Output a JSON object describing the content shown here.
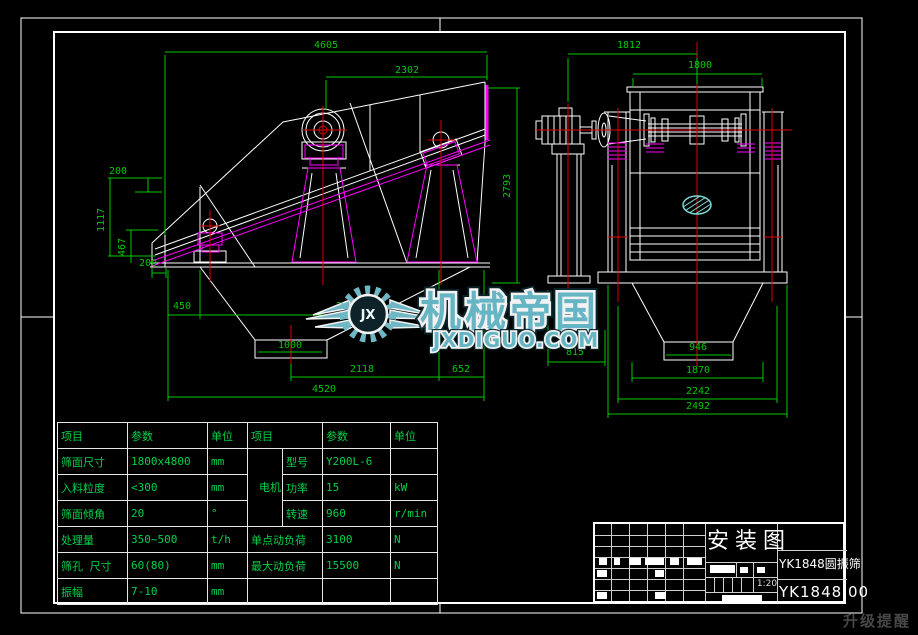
{
  "sheet": {
    "title": "安装图",
    "product": "YK1848圆振筛",
    "drawing_no": "YK1848.00",
    "scale": "1:20"
  },
  "watermark": {
    "monogram": "JX",
    "brand": "机械帝国",
    "domain": "JXDIGUO.COM"
  },
  "corner_note": "升级提醒",
  "param_table_left": {
    "headers": [
      "项目",
      "参数",
      "单位"
    ],
    "rows": [
      [
        "筛面尺寸",
        "1800x4800",
        "mm"
      ],
      [
        "入料粒度",
        "<300",
        "mm"
      ],
      [
        "筛面倾角",
        "20",
        "°"
      ],
      [
        "处理量",
        "350~500",
        "t/h"
      ],
      [
        "筛孔 尺寸",
        "60(80)",
        "mm"
      ],
      [
        "振幅",
        "7-10",
        "mm"
      ]
    ]
  },
  "param_table_right": {
    "headers": [
      "项目",
      "参数",
      "单位"
    ],
    "motor_label": "电机",
    "motor_rows": [
      [
        "型号",
        "Y200L-6",
        ""
      ],
      [
        "功率",
        "15",
        "kW"
      ],
      [
        "转速",
        "960",
        "r/min"
      ]
    ],
    "rows": [
      [
        "单点动负荷",
        "3100",
        "N"
      ],
      [
        "最大动负荷",
        "15500",
        "N"
      ],
      [
        "",
        "",
        ""
      ]
    ]
  },
  "dims": {
    "side": {
      "overall_len": "4605",
      "to_exciter": "2302",
      "top_offset": "200",
      "feed_height": "1117",
      "base_height": "467",
      "base_offset": "200",
      "d450": "450",
      "d2455": "2455",
      "opening": "1000",
      "d2118": "2118",
      "d652": "652",
      "base_len": "4520",
      "height": "2793"
    },
    "front": {
      "motor_span": "1812",
      "width": "1800",
      "d815": "815",
      "opening": "946",
      "d1870": "1870",
      "d2242": "2242",
      "base_width": "2492"
    }
  }
}
